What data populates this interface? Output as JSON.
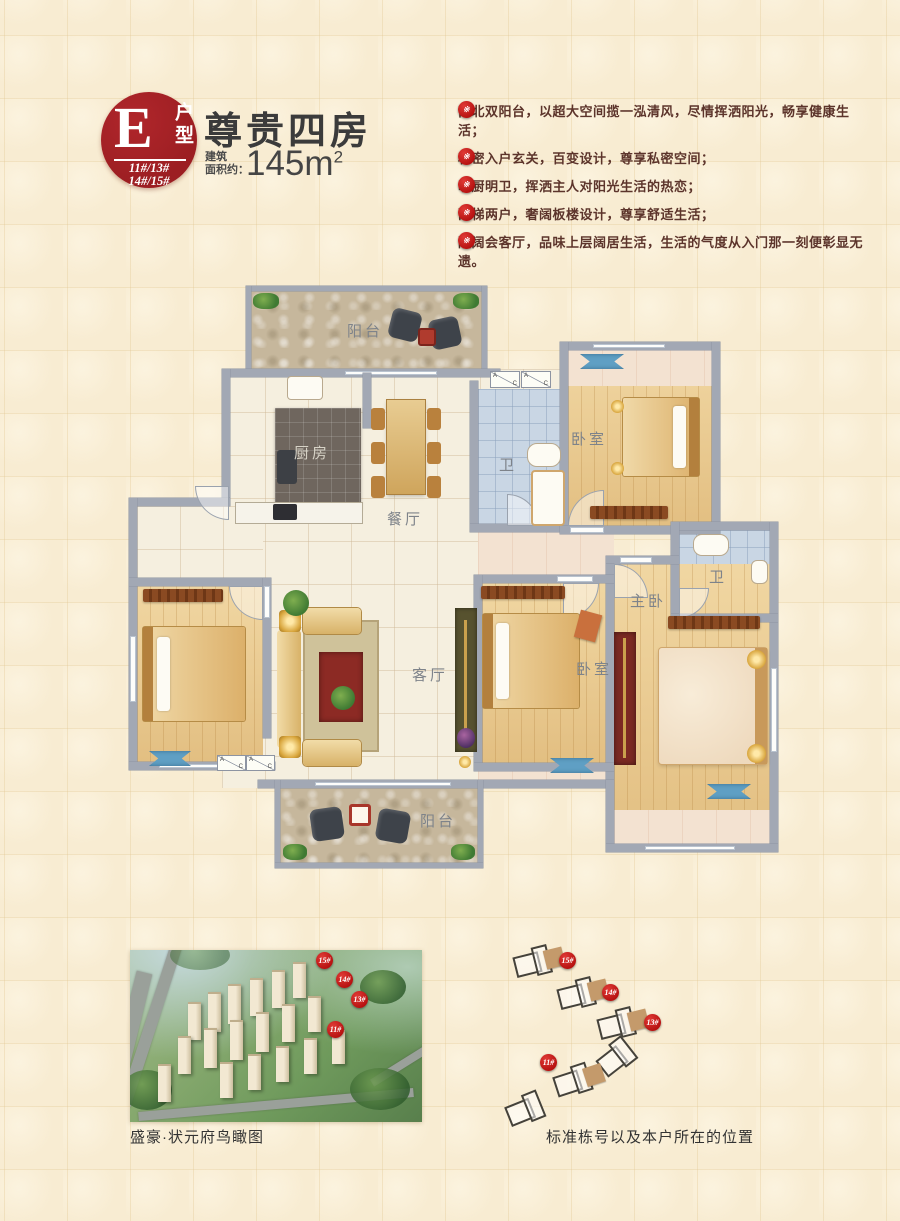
{
  "badge": {
    "letter": "E",
    "unit_type": "户型",
    "building_lines": [
      "11#/13#",
      "14#/15#"
    ]
  },
  "header": {
    "title": "尊贵四房",
    "area_label_line1": "建筑",
    "area_label_line2": "面积约：",
    "area_value": "145m",
    "area_superscript": "2"
  },
  "features": {
    "marker": "※",
    "items": [
      "南北双阳台，以超大空间揽一泓清风，尽情挥洒阳光，畅享健康生活；",
      "私密入户玄关，百变设计，尊享私密空间；",
      "明厨明卫，挥洒主人对阳光生活的热恋；",
      "两梯两户，奢阔板楼设计，尊享舒适生活；",
      "敞阔会客厅，品味上层阔居生活，生活的气度从入门那一刻便彰显无遗。"
    ]
  },
  "floorplan": {
    "rooms": {
      "balcony_top": "阳台",
      "kitchen": "厨房",
      "dining": "餐厅",
      "bath1": "卫",
      "bedroom_top_right": "卧室",
      "master_bedroom": "主卧",
      "bath2": "卫",
      "living": "客厅",
      "bedroom_center": "卧室",
      "balcony_bottom": "阳台"
    },
    "ac": {
      "a": "A",
      "c": "C"
    }
  },
  "aerial": {
    "markers": [
      "15#",
      "14#",
      "13#",
      "11#"
    ],
    "caption": "盛豪·状元府鸟瞰图"
  },
  "site_diagram": {
    "markers": [
      "15#",
      "14#",
      "13#",
      "11#"
    ],
    "caption": "标准栋号以及本户所在的位置"
  },
  "colors": {
    "badge_red": "#9c1e22",
    "marker_red": "#b5100f",
    "title_text": "#3b3b3b",
    "feature_text": "#5c342b",
    "wall_gray": "#a2a8b4",
    "wood_floor": "#e9c98e",
    "bath_tile": "#c9d6e4",
    "stone_floor": "#c6b79c",
    "background": "#f8ecd2"
  }
}
